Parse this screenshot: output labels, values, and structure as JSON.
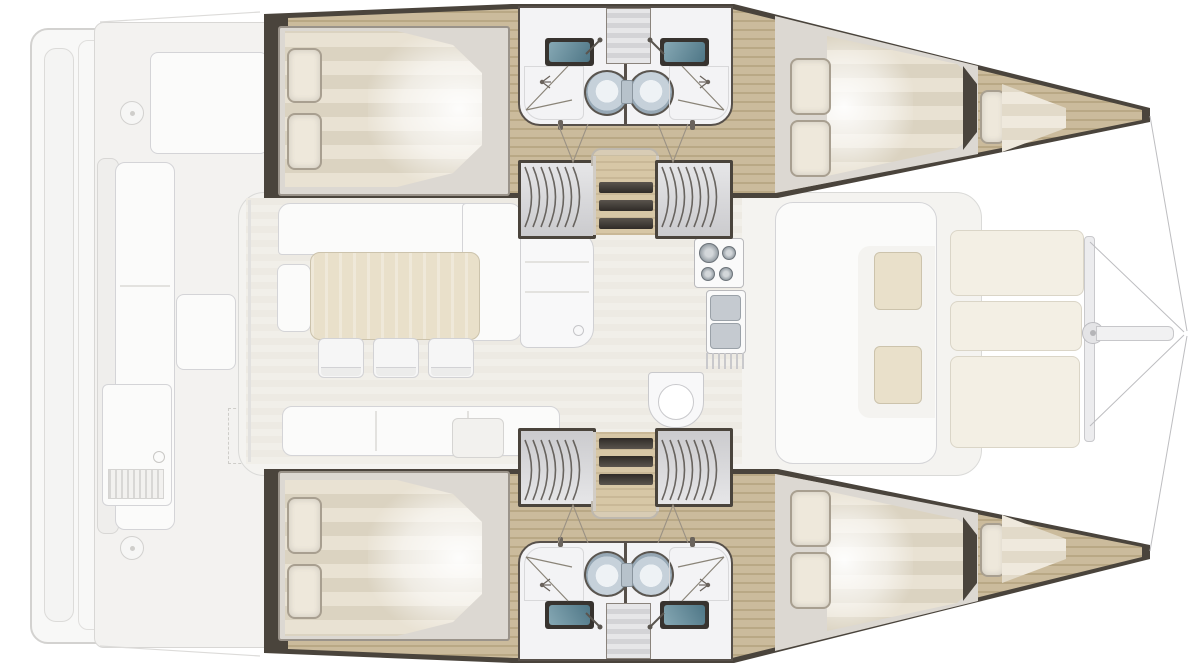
{
  "meta": {
    "diagram_type": "boat floor plan",
    "view": "top-down interior layout",
    "orientation": {
      "bow": "right",
      "stern": "left"
    }
  },
  "vessel": {
    "type": "catamaran",
    "layout": "4-cabin / 4-head",
    "hulls": [
      {
        "name": "port-hull",
        "highlighted": true,
        "rooms": [
          {
            "name": "aft-cabin",
            "furniture": [
              "double-berth",
              "pillow",
              "pillow"
            ]
          },
          {
            "name": "aft-bathroom",
            "furniture": [
              "sink",
              "toilet",
              "shower"
            ]
          },
          {
            "name": "forward-bathroom",
            "furniture": [
              "sink",
              "toilet",
              "shower"
            ]
          },
          {
            "name": "companionway",
            "furniture": [
              "stairs",
              "wardrobe",
              "wardrobe"
            ]
          },
          {
            "name": "forward-cabin",
            "furniture": [
              "double-berth",
              "pillow",
              "pillow"
            ]
          },
          {
            "name": "forepeak-berth",
            "furniture": [
              "single-berth",
              "pillow"
            ]
          }
        ]
      },
      {
        "name": "starboard-hull",
        "highlighted": true,
        "rooms": [
          {
            "name": "aft-cabin",
            "furniture": [
              "double-berth",
              "pillow",
              "pillow"
            ]
          },
          {
            "name": "aft-bathroom",
            "furniture": [
              "sink",
              "toilet",
              "shower"
            ]
          },
          {
            "name": "forward-bathroom",
            "furniture": [
              "sink",
              "toilet",
              "shower"
            ]
          },
          {
            "name": "companionway",
            "furniture": [
              "stairs",
              "wardrobe",
              "wardrobe"
            ]
          },
          {
            "name": "forward-cabin",
            "furniture": [
              "double-berth",
              "pillow",
              "pillow"
            ]
          },
          {
            "name": "forepeak-berth",
            "furniture": [
              "single-berth",
              "pillow"
            ]
          }
        ]
      }
    ],
    "deck": {
      "highlighted": false,
      "areas": [
        {
          "name": "swim-platform"
        },
        {
          "name": "aft-cockpit",
          "furniture": [
            "sunpad",
            "bench-seat",
            "cockpit-table",
            "grill-module",
            "liferaft-locker",
            "deck-hatch",
            "deck-hatch"
          ]
        },
        {
          "name": "saloon",
          "furniture": [
            "l-sofa",
            "side-seat",
            "dining-table",
            "chair",
            "chair",
            "chair",
            "forward-bench",
            "galley-counter",
            "stove",
            "double-sink",
            "dish-drainer",
            "galley-peninsula"
          ]
        },
        {
          "name": "forward-cockpit",
          "furniture": [
            "c-sofa",
            "side-table",
            "side-table"
          ]
        },
        {
          "name": "foredeck",
          "furniture": [
            "trampoline-panel",
            "trampoline-panel",
            "trampoline-panel",
            "crossbeam",
            "beam-fitting",
            "bowsprit",
            "forestay-bridle"
          ]
        }
      ]
    }
  },
  "counts": {
    "cabins": 4,
    "heads": 4,
    "pillows_per_double_berth": 2,
    "dining_chairs": 3,
    "stair_treads": 3,
    "trampoline_panels": 3,
    "wardrobes_per_hull": 2
  },
  "palette": {
    "hull-wall": "#4a443c",
    "wood-floor": "#cbbb9c",
    "wood-floor-stripe": "#b9a885",
    "bed-platform": "#dcd8d2",
    "bed-platform-border": "#9a938a",
    "mattress-light": "#e9e2d3",
    "mattress-dark": "#dbd3c1",
    "pillow": "#eee8db",
    "pillow-border": "#a89f90",
    "bath-floor": "#f3f3f5",
    "sink-frame": "#37332f",
    "sink-teal": "#57808f",
    "toilet-rim": "#97a8b5",
    "wardrobe-arc": "#55504a",
    "faded-fill": "#f4f3f0",
    "faded-white": "#fbfbfa",
    "faded-border": "#d4d4d7",
    "saloon-table": "#e9e0ca",
    "saloon-table-border": "#ccc3ac",
    "tramp-panel": "#f3efe4",
    "tramp-border": "#dad5c7",
    "line-color": "#bdbdc0"
  }
}
